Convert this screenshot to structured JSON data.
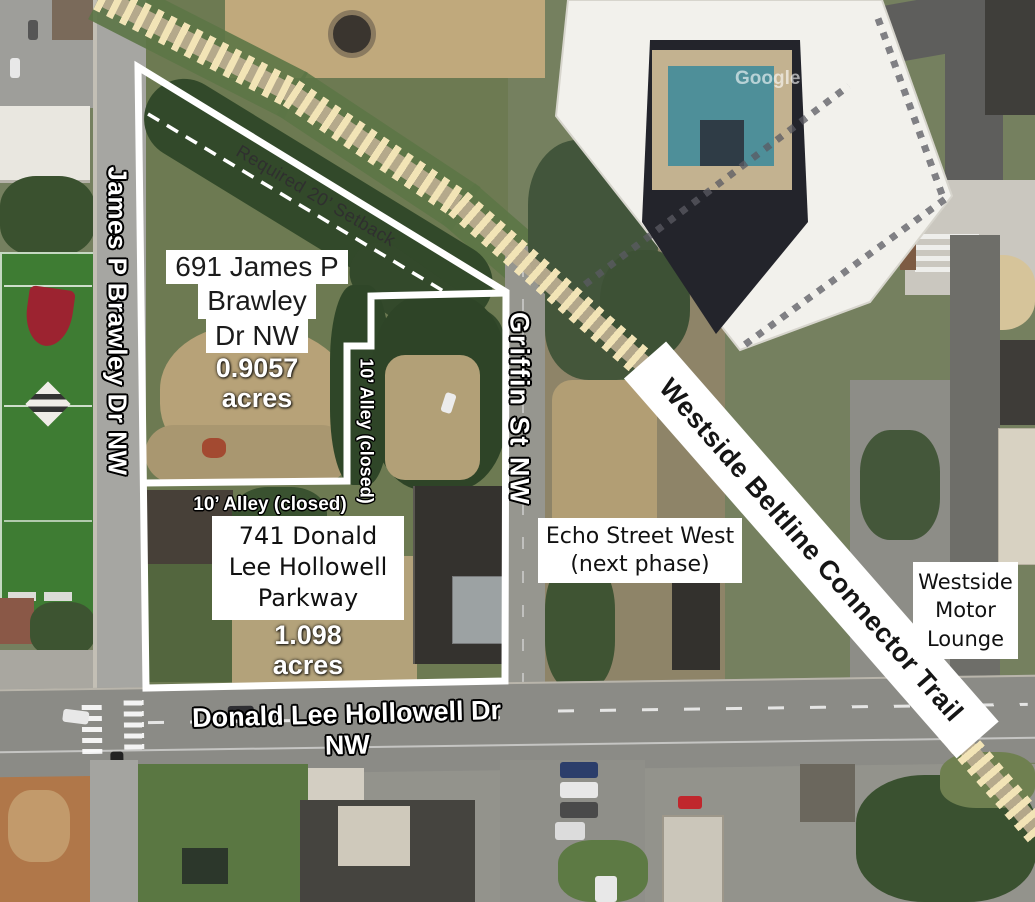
{
  "canvas": {
    "width": 1035,
    "height": 902
  },
  "streets": {
    "west_vertical": "James P Brawley Dr NW",
    "center_vertical": "Griffin St NW",
    "south_horizontal": "Donald Lee Hollowell Dr NW"
  },
  "alleys": {
    "horizontal_label": "10’ Alley (closed)",
    "vertical_label": "10’ Alley (closed)"
  },
  "setback_label": "Required 20’ Setback",
  "trail_label": "Westside Beltline Connector Trail",
  "parcels": [
    {
      "address_lines": [
        "691 James P",
        "Brawley",
        "Dr NW"
      ],
      "area": "0.9057",
      "area_unit": "acres"
    },
    {
      "address_lines": [
        "741 Donald",
        "Lee Hollowell",
        "Parkway"
      ],
      "area": "1.098",
      "area_unit": "acres"
    }
  ],
  "landmarks": {
    "echo_lines": [
      "Echo Street West",
      "(next phase)"
    ],
    "motor_lounge_lines": [
      "Westside",
      "Motor",
      "Lounge"
    ]
  },
  "watermark": "Google",
  "icons": [
    "salvation-army-shield-icon",
    "boys-girls-club-logo-icon"
  ],
  "colors": {
    "boundary": "#ffffff",
    "setback_text": "#2f2f2f",
    "trail_band": "#ffffff",
    "trail_text": "#151515",
    "hatch": "#f2e4b6",
    "pool": "#4e8f99"
  }
}
